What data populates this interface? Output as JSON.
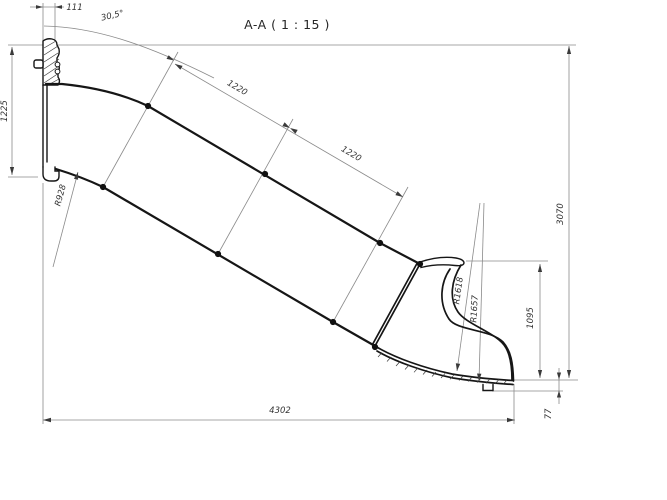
{
  "title": "A-A ( 1 : 15 )",
  "drawing": {
    "section_name": "A-A",
    "scale": "1 : 15",
    "subject": "slide-side-section-profile"
  },
  "dimensions": {
    "platform_thickness": "111",
    "slope_angle": "30,5°",
    "entry_height": "1225",
    "entry_curve_radius": "R928",
    "segment_1_length": "1220",
    "segment_2_length": "1220",
    "exit_curve_radius_inner": "R1618",
    "exit_curve_radius_outer": "R1657",
    "overall_height": "3070",
    "exit_section_height": "1095",
    "foot_height": "77",
    "overall_length": "4302"
  },
  "colors": {
    "background": "#ffffff",
    "profile_line": "#161616",
    "dimension_line": "#8a8a8a",
    "text": "#333333"
  }
}
